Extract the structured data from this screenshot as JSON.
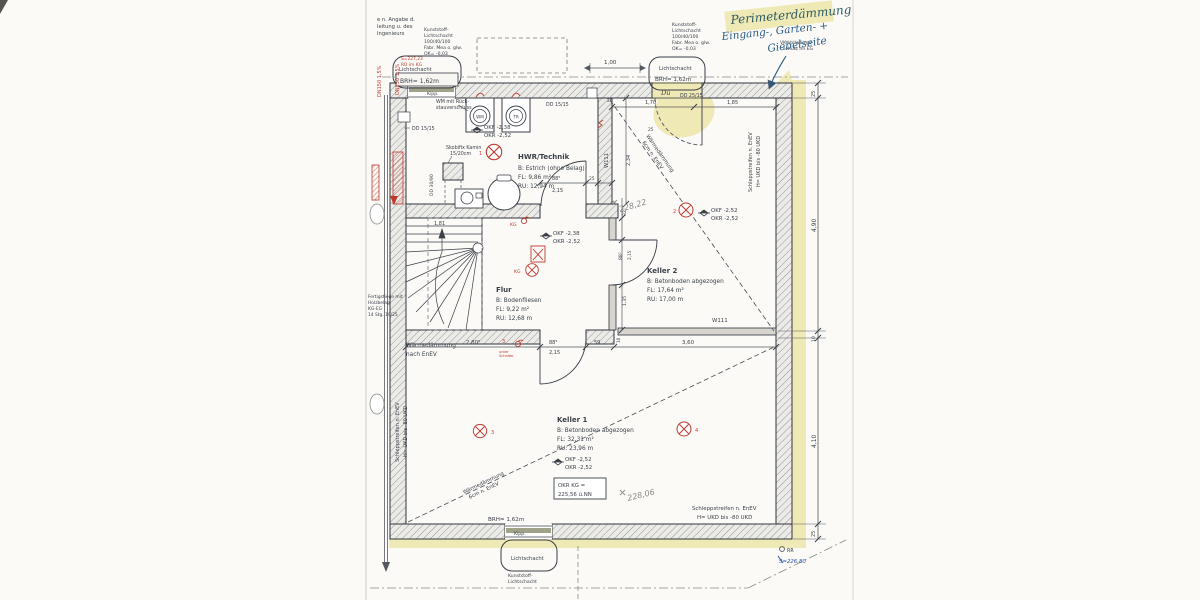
{
  "colors": {
    "ink": "#3a3f47",
    "red_marking": "#c03a2e",
    "highlighter_yellow": "#e0d562",
    "handwriting_green": "#2d5a63",
    "handwriting_blue": "#2a5a85",
    "pen_blue": "#2456a8",
    "pencil_gray": "#8b8b88",
    "sill_green": "#a0a389"
  },
  "handwritten": {
    "perimeter": "Perimeterdämmung",
    "line1": "Eingang-, Garten- +",
    "line2": "Giebelseite",
    "due": "Dü",
    "lvl_k2": "228,22",
    "lvl_k1": "228,06",
    "lvl_blue": "S=226,80"
  },
  "notes": {
    "cut1": "e n. Angabe d.",
    "cut2": "leitung u. des",
    "cut3": "Ingenieurs",
    "ls1": "Kunststoff-",
    "ls2": "Lichtschacht",
    "ls3": "100/40/100",
    "ls4": "Fabr. Mea o. glw.",
    "ls5": "OK= -0,03",
    "vk1": "VK Vollwärme-",
    "vk2": "schutz im EG",
    "wm1": "WM mit Rück-",
    "wm2": "stauverschluss",
    "kamin1": "Skobifix Kamin",
    "kamin2": "15/20cm",
    "stair1": "Fertigstiege mit",
    "stair2": "Holzbelag",
    "stair3": "KG-EG",
    "stair4": "14 Stg. 19/25",
    "dn150": "DN150 1,5%",
    "red1": "S=227,23",
    "red2": "RD im KG",
    "unter1": "unter",
    "unter2": "Schalter"
  },
  "lichtschacht": {
    "label": "Lichtschacht",
    "brh": "BRH= 1,62m",
    "kipp": "Kipp."
  },
  "rooms": {
    "hwr": {
      "name": "HWR/Technik",
      "floor": "B: Estrich (ohne Belag)",
      "area": "FL: 9,86 m²",
      "per": "RU: 12,94 m"
    },
    "flur": {
      "name": "Flur",
      "floor": "B: Bodenfliesen",
      "area": "FL: 9,22 m²",
      "per": "RU: 12,68 m"
    },
    "k2": {
      "name": "Keller 2",
      "floor": "B: Betonboden abgezogen",
      "area": "FL: 17,64 m²",
      "per": "RU: 17,00 m"
    },
    "k1": {
      "name": "Keller 1",
      "floor": "B: Betonboden abgezogen",
      "area": "FL: 32,31 m²",
      "per": "RU: 23,96 m"
    }
  },
  "levels": {
    "okf238": "OKF -2,38",
    "okr252": "OKR -2,52",
    "okf252": "OKF -2,52",
    "okr_box1": "OKR KG =",
    "okr_box2": "225,56 ü.NN"
  },
  "walls": {
    "w111": "W111",
    "dd1515": "DD 15/15",
    "dd2515": "DD 25/15",
    "dd3090": "DD 30/90"
  },
  "insulation": {
    "wd1": "Wärmedämmung",
    "wd2": "6cm n. EnEV",
    "wd3": "nach EnEV",
    "ss1": "Schleppstreifen n. EnEV",
    "ss2": "H= UKD bis -80 UKD"
  },
  "dims": {
    "d100": "1,00",
    "d170": "1,70",
    "d185": "1,85",
    "d181": "1,81",
    "d234": "2,34",
    "d2805": "2,80⁵",
    "d885": "88⁵",
    "d215": "2,15",
    "d59": "59",
    "d360": "3,60",
    "d325": "32⁵",
    "d135": "1,35",
    "d25": "25",
    "d10": "10",
    "d490": "4,90",
    "d410": "4,10"
  },
  "electrical": {
    "n1": "1",
    "n2": "2",
    "n3": "3",
    "n4": "4",
    "kg": "KG"
  },
  "appliances": {
    "wm": "WM",
    "tr": "TR"
  },
  "misc": {
    "rr": "RR"
  }
}
